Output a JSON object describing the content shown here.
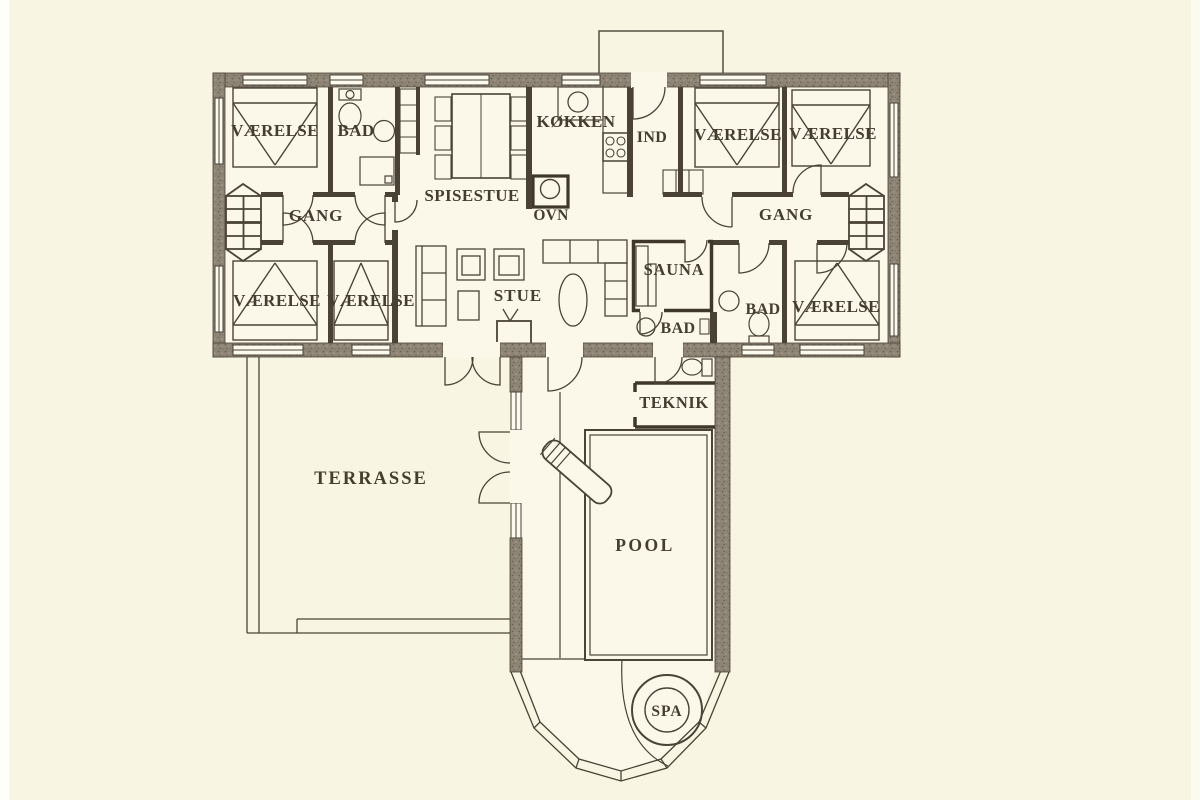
{
  "figure_type": "architectural floor plan (Danish holiday house)",
  "plan": {
    "labels": {
      "vaerelse_top_left": "VÆRELSE",
      "bad_top_left": "BAD",
      "spisestue": "SPISESTUE",
      "koekken": "KØKKEN",
      "ind": "IND",
      "vaerelse_top_mid": "VÆRELSE",
      "vaerelse_top_right": "VÆRELSE",
      "gang_left": "GANG",
      "gang_right": "GANG",
      "ovn": "OVN",
      "vaerelse_bottom_left": "VÆRELSE",
      "vaerelse_bottom_mid": "VÆRELSE",
      "stue": "STUE",
      "sauna": "SAUNA",
      "bad_center": "BAD",
      "bad_right": "BAD",
      "vaerelse_bottom_right": "VÆRELSE",
      "teknik": "TEKNIK",
      "terrasse": "TERRASSE",
      "pool": "POOL",
      "spa": "SPA"
    },
    "colors": {
      "page_background": "#f8f5e2",
      "room_floor": "#fbf8ea",
      "wall_fill": "#8f8576",
      "wall_speckle_dark": "#6c6253",
      "wall_speckle_light": "#a79d8d",
      "line": "#4a4337",
      "text": "#453e2f"
    },
    "icons": [
      "bed-icon",
      "dining-table-icon",
      "chair-icon",
      "sofa-icon",
      "armchair-icon",
      "tv-icon",
      "coffee-table-icon",
      "rug-oval-icon",
      "stove-icon",
      "sink-icon",
      "oven-icon",
      "toilet-icon",
      "shower-icon",
      "closet-icon",
      "sauna-bench-icon",
      "bay-window-icon",
      "door-swing-icon",
      "window-icon",
      "pool-icon",
      "water-slide-icon",
      "spa-tub-icon",
      "chimney-icon"
    ]
  }
}
